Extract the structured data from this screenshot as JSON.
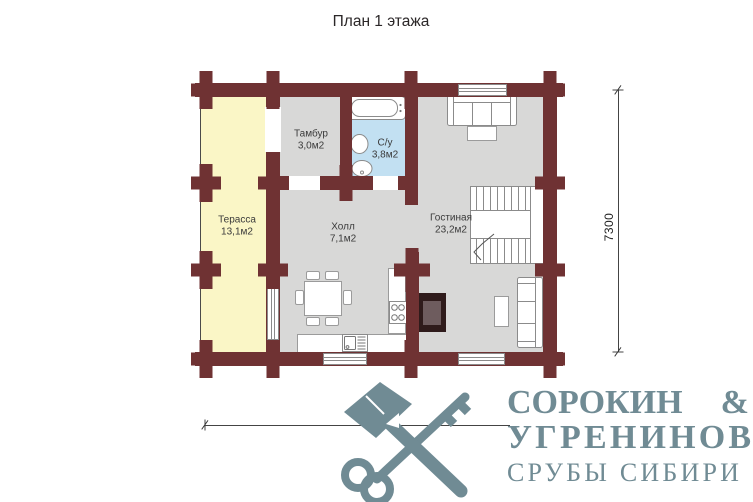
{
  "title": "План 1 этажа",
  "plan": {
    "rooms": {
      "terrace": {
        "name": "Терасса",
        "area": "13,1м2"
      },
      "tambur": {
        "name": "Тамбур",
        "area": "3,0м2"
      },
      "su": {
        "name": "С/у",
        "area": "3,8м2"
      },
      "hall": {
        "name": "Холл",
        "area": "7,1м2"
      },
      "living": {
        "name": "Гостиная",
        "area": "23,2м2"
      }
    },
    "dimensions": {
      "width_mm": "9300",
      "height_mm": "7300"
    },
    "colors": {
      "wall": "#6f3233",
      "terrace_floor": "#faf6c6",
      "room_floor": "#d8d8d7",
      "bathroom_floor": "#c2e0f2",
      "fireplace_outer": "#2f1b1b",
      "fireplace_inner": "#6e5c5e"
    }
  },
  "logo": {
    "icon": "axe-and-key-icon",
    "color": "#708b94",
    "name_line1": "СОРОКИН",
    "ampersand": "&",
    "name_line2": "УГРЕНИНОВ",
    "tagline": "СРУБЫ СИБИРИ"
  }
}
